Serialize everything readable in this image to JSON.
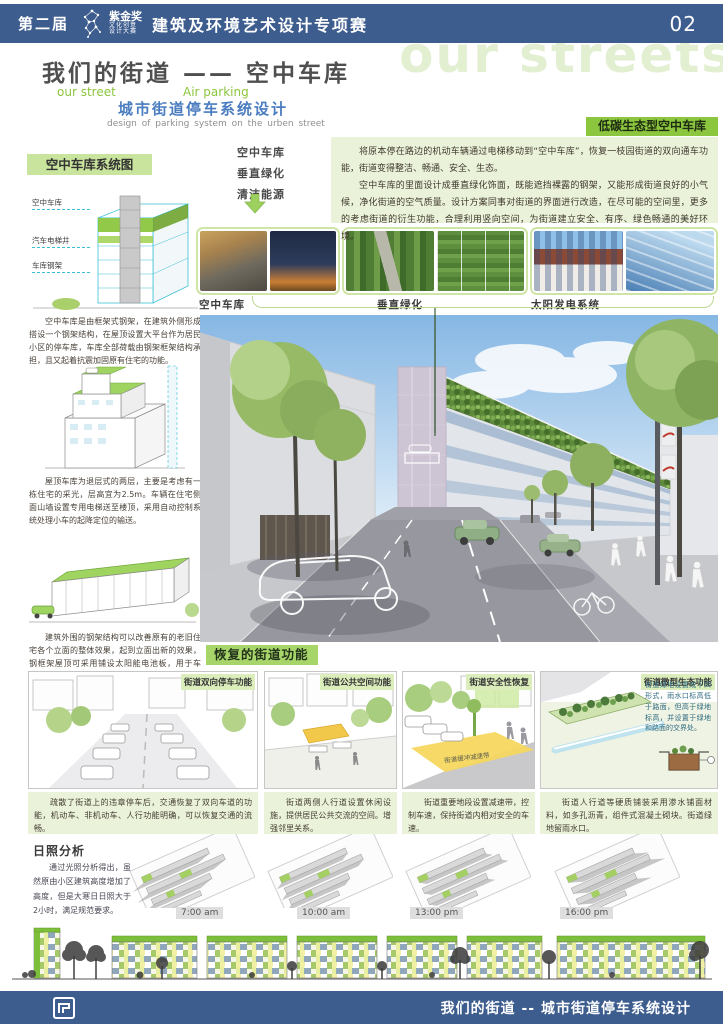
{
  "header": {
    "edition": "第二届",
    "logo": {
      "title": "紫金奖",
      "line2": "文化创意",
      "line3": "设计大赛"
    },
    "competition": "建筑及环境艺术设计专项赛",
    "page_number": "02"
  },
  "watermark": "our streets",
  "title_block": {
    "main": "我们的街道 —— 空中车库",
    "en_left": "our street",
    "en_right": "Air parking",
    "sub_cn": "城市街道停车系统设计",
    "sub_en": "design of  parking system on the urben street"
  },
  "intro": {
    "label": "低碳生态型空中车库",
    "p1": "将原本停在路边的机动车辆通过电梯移动到“空中车库”，恢复一枝园街道的双向通车功能，街道变得整洁、畅通、安全、生态。",
    "p2": "空中车库的里面设计成垂直绿化饰面，既能遮挡裸露的钢架，又能形成街道良好的小气候，净化街道的空气质量。设计方案同事对街道的界面进行改造，在尽可能的空间里，更多的考虑街道的衍生功能，合理利用竖向空间，为街道建立安全、有序、绿色畅通的美好环境。"
  },
  "system": {
    "label": "空中车库系统图",
    "keywords": [
      "空中车库",
      "垂直绿化",
      "清洁能源"
    ],
    "diagram1_labels": [
      "空中车库",
      "汽车电梯井",
      "车库钢架"
    ],
    "caption1": "空中车库是由框架式钢架，在建筑外侧形成搭设一个钢架结构，在屋顶设置大平台作为居民小区的停车库，车库全部荷载由钢架框架结构承担，且又起着抗震加固原有住宅的功能。",
    "caption2": "屋顶车库为退层式的两层，主要是考虑有一栋住宅的采光，层高宜为2.5m。车辆在住宅侧面山墙设置专用电梯送至楼顶，采用自动控制系统处理小车的起降定位的输送。",
    "caption3": "建筑外围的钢架结构可以改善原有的老旧住宅各个立面的整体效果，起到立面出新的效果，钢框架屋顶可采用铺设太阳能电池板，用于车库、小区内日常用电。"
  },
  "photos": {
    "captions": [
      "空中车库",
      "垂直绿化",
      "太阳发电系统"
    ]
  },
  "street_functions": {
    "label": "恢复的街道功能",
    "panels": [
      {
        "header": "街道双向停车功能",
        "caption": "疏散了街道上的违章停车后，交通恢复了双向车道的功能，机动车、非机动车、人行功能明确，可以恢复交通的流畅。"
      },
      {
        "header": "街道公共空间功能",
        "caption": "街道两侧人行道设置休闲设施，提供居民公共交流的空间。增强邻里关系。"
      },
      {
        "header": "街道安全性恢复",
        "caption": "街道重要地段设置减速带，控制车速，保持街道内相对安全的车速。",
        "road_label": "街道缓冲减速带"
      },
      {
        "header": "街道微型生态功能",
        "caption": "街道人行道等硬质铺装采用渗水铺面材料，如多孔沥青，组件式混凝土砌块。街道绿地留雨水口。",
        "annotation": "街道绿地设置成下凹形式，雨水口标高低于路面，但高于绿地标高，并设置于绿地和路面的交界处。"
      }
    ]
  },
  "sun": {
    "title": "日照分析",
    "paragraph": "通过光照分析得出，虽然原由小区建筑高度增加了高度，但是大寒日日照大于2小时，满足规范要求。",
    "times": [
      "7:00 am",
      "10:00 am",
      "13:00 pm",
      "16:00 pm"
    ]
  },
  "footer": {
    "text": "我们的街道 -- 城市街道停车系统设计"
  },
  "colors": {
    "header_blue": "#3d5d8f",
    "accent_green": "#8cc63e",
    "label_green": "#c9e49c",
    "light_green_bg": "#eaf3da",
    "panel_header_green": "#dcedbc",
    "restore_green": "#a7d56a"
  }
}
